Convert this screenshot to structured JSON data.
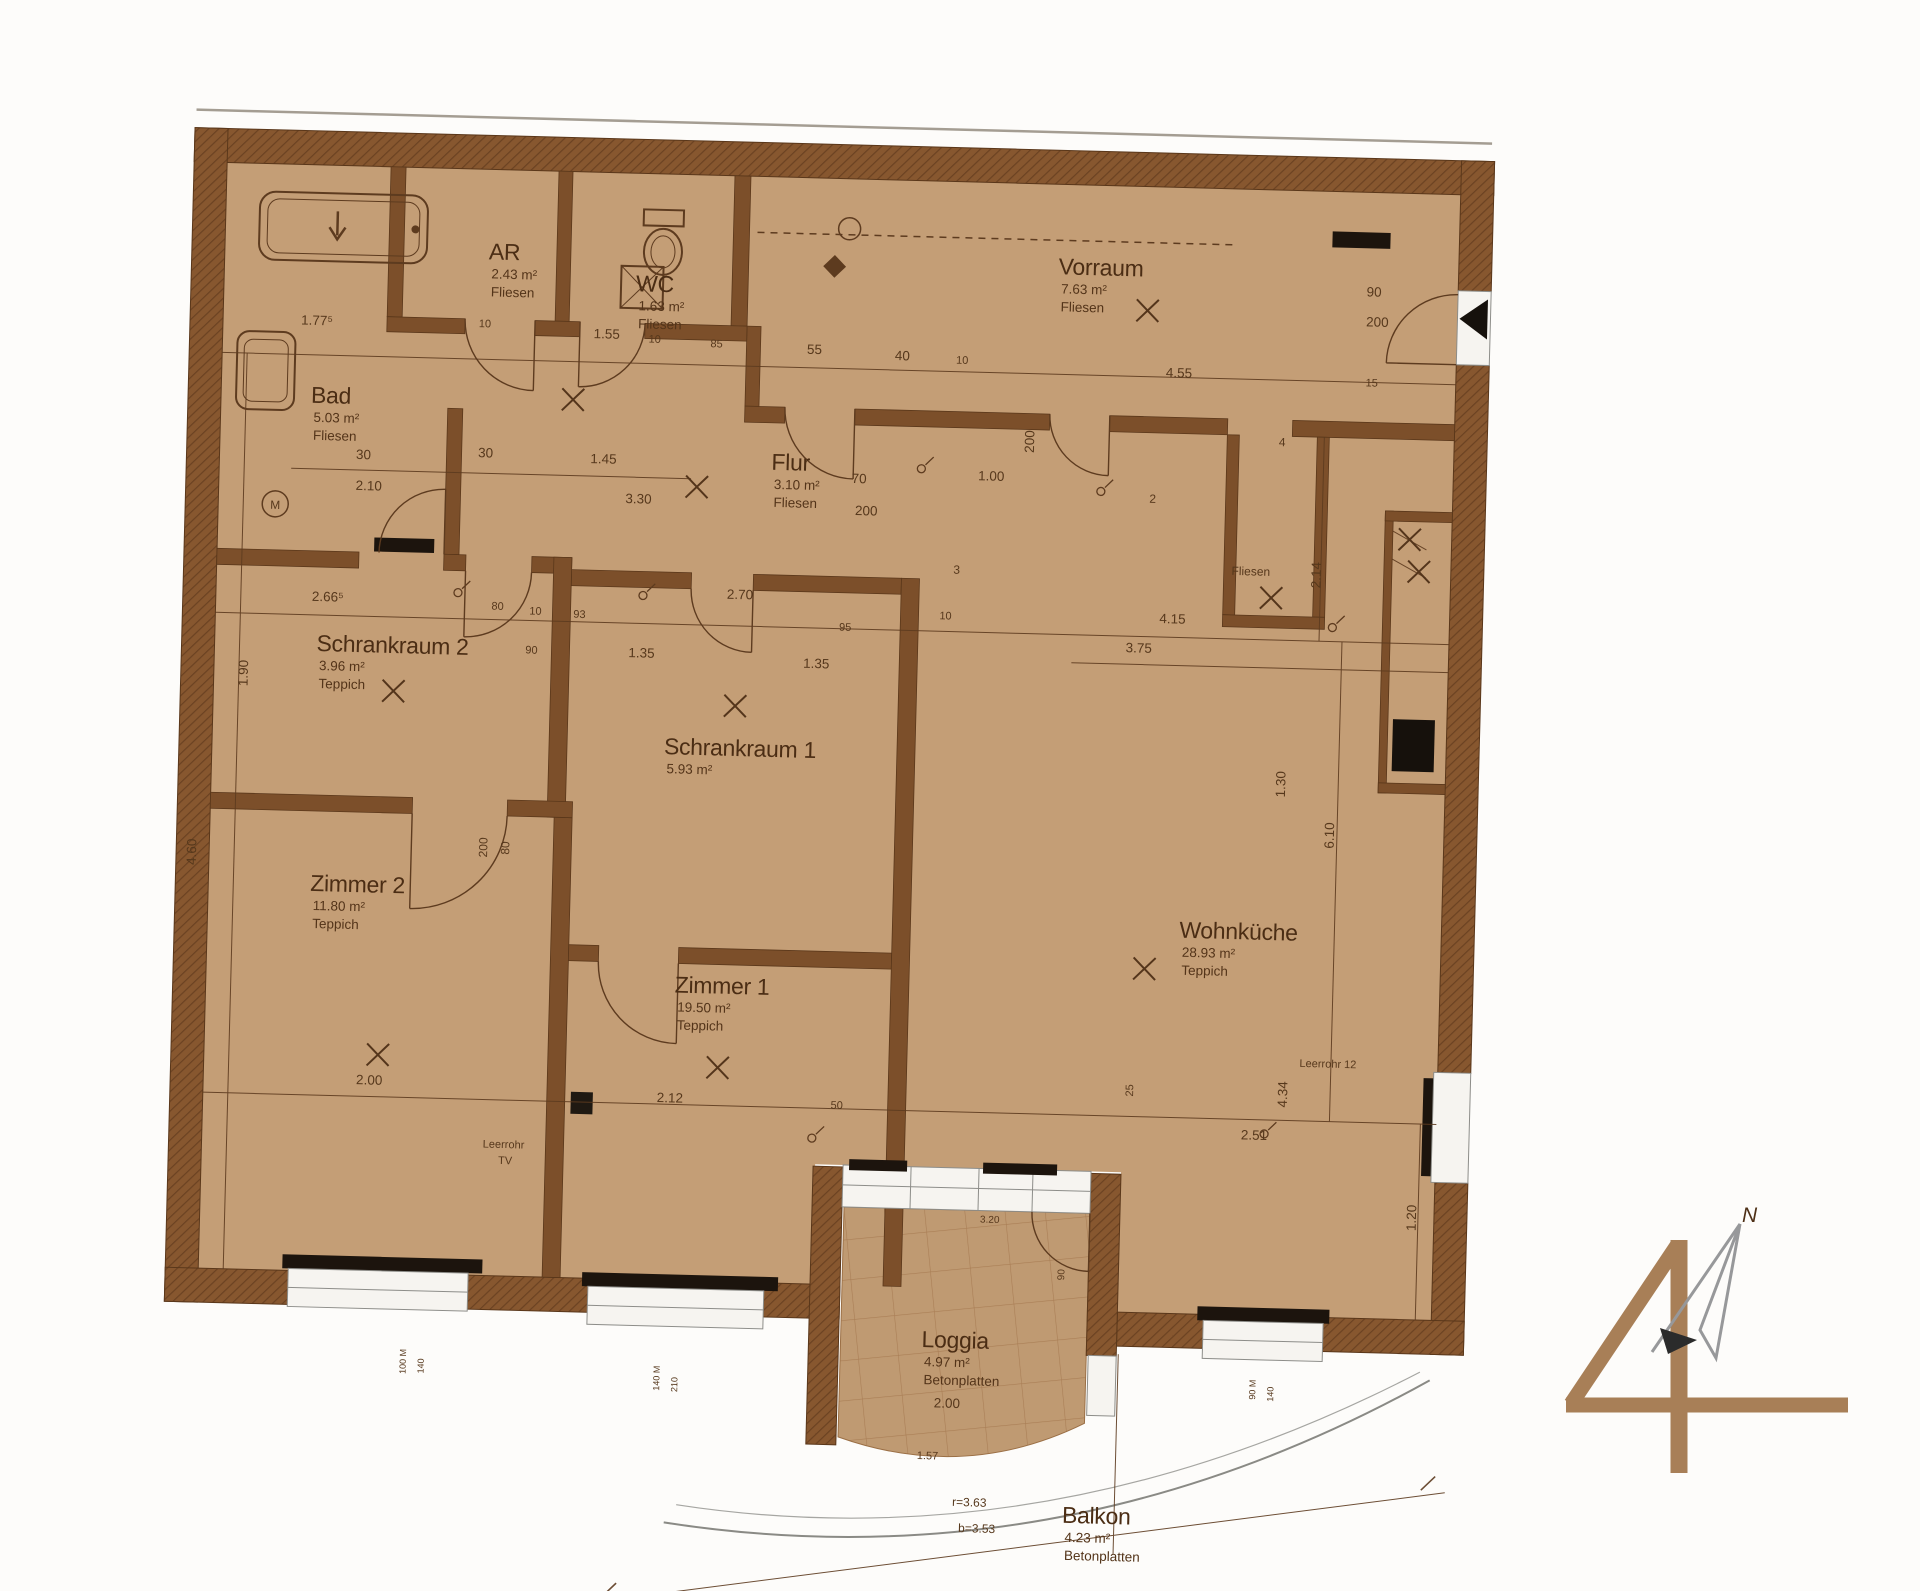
{
  "title": "Wohnungsplan Top 4",
  "colors": {
    "floor": "#c59e76",
    "wall": "#7c4f29",
    "wall_hatch": "#8a5a30",
    "wall_hatch_line": "#6b4121",
    "line": "#5d3a1e",
    "text": "#4e2f16",
    "black": "#1b130c",
    "white": "#f7f5f1",
    "window_frame": "#8d8d89",
    "tile_line": "#a1744a",
    "logo_brown": "#a87f57",
    "north_gray": "#97989a"
  },
  "plan": {
    "rooms": [
      {
        "name": "Bad",
        "area": "5.03 m²",
        "flooring": "Fliesen",
        "x": 318,
        "y": 400,
        "ns": 24
      },
      {
        "name": "AR",
        "area": "2.43 m²",
        "flooring": "Fliesen",
        "x": 492,
        "y": 252,
        "ns": 22
      },
      {
        "name": "WC",
        "area": "1.63 m²",
        "flooring": "Fliesen",
        "x": 640,
        "y": 280,
        "ns": 22
      },
      {
        "name": "Vorraum",
        "area": "7.63 m²",
        "flooring": "Fliesen",
        "x": 1062,
        "y": 252,
        "ns": 24
      },
      {
        "name": "Flur",
        "area": "3.10 m²",
        "flooring": "Fliesen",
        "x": 780,
        "y": 455,
        "ns": 24
      },
      {
        "name": "Schrankraum 2",
        "area": "3.96 m²",
        "flooring": "Teppich",
        "x": 330,
        "y": 648,
        "ns": 23
      },
      {
        "name": "Schrankraum 1",
        "area": "5.93 m²",
        "flooring": "",
        "x": 680,
        "y": 742,
        "ns": 23
      },
      {
        "name": "Zimmer 2",
        "area": "11.80 m²",
        "flooring": "Teppich",
        "x": 330,
        "y": 888,
        "ns": 26
      },
      {
        "name": "Zimmer 1",
        "area": "19.50 m²",
        "flooring": "Teppich",
        "x": 697,
        "y": 980,
        "ns": 26
      },
      {
        "name": "Wohnküche",
        "area": "28.93 m²",
        "flooring": "Teppich",
        "x": 1200,
        "y": 912,
        "ns": 26
      },
      {
        "name": "Loggia",
        "area": "4.97 m²",
        "flooring": "Betonplatten",
        "x": 953,
        "y": 1328,
        "ns": 24
      },
      {
        "name": "Balkon",
        "area": "4.23 m²",
        "flooring": "Betonplatten",
        "x": 1098,
        "y": 1500,
        "ns": 24
      }
    ],
    "dims": [
      {
        "t": "1.77⁵",
        "x": 322,
        "y": 322
      },
      {
        "t": "10",
        "x": 490,
        "y": 320,
        "s": 11
      },
      {
        "t": "1.55",
        "x": 612,
        "y": 328
      },
      {
        "t": "10",
        "x": 660,
        "y": 331,
        "s": 11
      },
      {
        "t": "85",
        "x": 722,
        "y": 334,
        "s": 11
      },
      {
        "t": "55",
        "x": 820,
        "y": 338
      },
      {
        "t": "40",
        "x": 908,
        "y": 342
      },
      {
        "t": "10",
        "x": 968,
        "y": 344,
        "s": 11
      },
      {
        "t": "4.55",
        "x": 1185,
        "y": 352
      },
      {
        "t": "15",
        "x": 1378,
        "y": 356,
        "s": 11
      },
      {
        "t": "30",
        "x": 372,
        "y": 455
      },
      {
        "t": "2.10",
        "x": 378,
        "y": 486
      },
      {
        "t": "30",
        "x": 494,
        "y": 450
      },
      {
        "t": "1.45",
        "x": 612,
        "y": 453
      },
      {
        "t": "3.30",
        "x": 648,
        "y": 492
      },
      {
        "t": "70",
        "x": 868,
        "y": 466
      },
      {
        "t": "200",
        "x": 876,
        "y": 498
      },
      {
        "t": "90",
        "x": 1378,
        "y": 266
      },
      {
        "t": "200",
        "x": 1382,
        "y": 296
      },
      {
        "t": "1.00",
        "x": 1000,
        "y": 460
      },
      {
        "t": "200",
        "x": 1042,
        "y": 420,
        "r": -90
      },
      {
        "t": "200",
        "x": 506,
        "y": 840,
        "r": -90,
        "s": 12
      },
      {
        "t": "80",
        "x": 528,
        "y": 840,
        "r": -90,
        "s": 12
      },
      {
        "t": "2.66⁵",
        "x": 340,
        "y": 598
      },
      {
        "t": "80",
        "x": 510,
        "y": 602,
        "s": 11
      },
      {
        "t": "10",
        "x": 548,
        "y": 606,
        "s": 11
      },
      {
        "t": "93",
        "x": 592,
        "y": 608,
        "s": 11
      },
      {
        "t": "90",
        "x": 545,
        "y": 645,
        "s": 11
      },
      {
        "t": "1.35",
        "x": 655,
        "y": 646
      },
      {
        "t": "1.35",
        "x": 830,
        "y": 652
      },
      {
        "t": "2.70",
        "x": 752,
        "y": 585
      },
      {
        "t": "95",
        "x": 858,
        "y": 614,
        "s": 11
      },
      {
        "t": "10",
        "x": 958,
        "y": 600,
        "s": 11
      },
      {
        "t": "4.15",
        "x": 1185,
        "y": 598
      },
      {
        "t": "3.75",
        "x": 1152,
        "y": 628
      },
      {
        "t": "1.90",
        "x": 262,
        "y": 672,
        "r": -90
      },
      {
        "t": "4.60",
        "x": 215,
        "y": 852,
        "r": -90
      },
      {
        "t": "2.14",
        "x": 1332,
        "y": 546,
        "r": -90
      },
      {
        "t": "1.30",
        "x": 1302,
        "y": 756,
        "r": -90
      },
      {
        "t": "6.10",
        "x": 1352,
        "y": 806,
        "r": -90
      },
      {
        "t": "4.34",
        "x": 1312,
        "y": 1066,
        "r": -90
      },
      {
        "t": "25",
        "x": 1158,
        "y": 1066,
        "r": -90,
        "s": 11
      },
      {
        "t": "1.20",
        "x": 1444,
        "y": 1186,
        "r": -90
      },
      {
        "t": "2.00",
        "x": 394,
        "y": 1080
      },
      {
        "t": "2.12",
        "x": 695,
        "y": 1090
      },
      {
        "t": "50",
        "x": 862,
        "y": 1092,
        "s": 11
      },
      {
        "t": "2.51",
        "x": 1280,
        "y": 1112
      },
      {
        "t": "2.00",
        "x": 980,
        "y": 1388
      },
      {
        "t": "1.57",
        "x": 962,
        "y": 1440,
        "s": 11
      },
      {
        "t": "Leerrohr",
        "x": 530,
        "y": 1140,
        "s": 11
      },
      {
        "t": "TV",
        "x": 532,
        "y": 1156,
        "s": 11
      },
      {
        "t": "Leerrohr 12",
        "x": 1352,
        "y": 1038,
        "s": 11
      },
      {
        "t": "r=3.63",
        "x": 1005,
        "y": 1486,
        "s": 12
      },
      {
        "t": "b=3.53",
        "x": 1013,
        "y": 1512,
        "s": 12
      },
      {
        "t": "100 M",
        "x": 438,
        "y": 1356,
        "r": -90,
        "s": 9
      },
      {
        "t": "140",
        "x": 456,
        "y": 1360,
        "r": -90,
        "s": 9
      },
      {
        "t": "140 M",
        "x": 692,
        "y": 1366,
        "r": -90,
        "s": 9
      },
      {
        "t": "210",
        "x": 710,
        "y": 1372,
        "r": -90,
        "s": 9
      },
      {
        "t": "90 M",
        "x": 1288,
        "y": 1362,
        "r": -90,
        "s": 9
      },
      {
        "t": "140",
        "x": 1306,
        "y": 1366,
        "r": -90,
        "s": 9
      },
      {
        "t": "2",
        "x": 1162,
        "y": 478,
        "s": 12
      },
      {
        "t": "3",
        "x": 968,
        "y": 554,
        "s": 12
      },
      {
        "t": "4",
        "x": 1290,
        "y": 418,
        "s": 12
      },
      {
        "t": "M",
        "x": 285,
        "y": 507,
        "s": 12
      },
      {
        "t": "Fliesen",
        "x": 1262,
        "y": 548,
        "s": 12
      },
      {
        "t": "3.20",
        "x": 1018,
        "y": 1202,
        "s": 10
      },
      {
        "t": "90",
        "x": 1094,
        "y": 1252,
        "r": -90,
        "s": 10
      }
    ],
    "x_marks": [
      [
        1152,
        286
      ],
      [
        706,
        474
      ],
      [
        408,
        686
      ],
      [
        750,
        692
      ],
      [
        402,
        1050
      ],
      [
        742,
        1054
      ],
      [
        1166,
        944
      ],
      [
        1283,
        570
      ],
      [
        580,
        390
      ],
      [
        1420,
        508
      ],
      [
        1430,
        540
      ]
    ]
  },
  "logo": {
    "number": "4",
    "north_label": "N"
  }
}
